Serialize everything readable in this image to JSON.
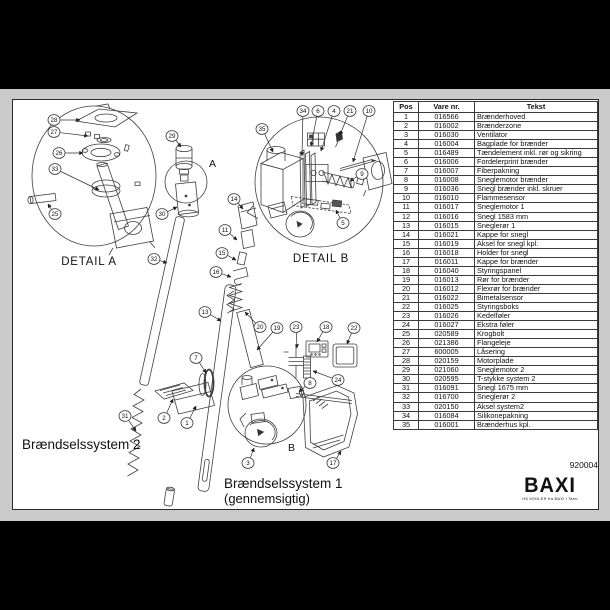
{
  "page": {
    "sheet_number": "920004"
  },
  "logo": {
    "brand": "BAXI",
    "tagline": "HS KEDLER fra BAXI i Tarm"
  },
  "labels": {
    "detail_a": "DETAIL A",
    "detail_b": "DETAIL B",
    "system2": "Brændselssystem 2",
    "system1": "Brændselssystem 1",
    "system1_sub": "(gennemsigtig)",
    "marker_a": "A",
    "marker_b": "B"
  },
  "table": {
    "headers": [
      "Pos",
      "Vare nr.",
      "Tekst"
    ],
    "rows": [
      [
        "1",
        "016566",
        "Brænderhoved"
      ],
      [
        "2",
        "016002",
        "Brænderzone"
      ],
      [
        "3",
        "016030",
        "Ventilator"
      ],
      [
        "4",
        "016004",
        "Bagplade for brænder"
      ],
      [
        "5",
        "016489",
        "Tændelement inkl. rør og sikring"
      ],
      [
        "6",
        "016006",
        "Fordelerprint brænder"
      ],
      [
        "7",
        "016007",
        "Fiberpakning"
      ],
      [
        "8",
        "016008",
        "Sneglemotor brænder"
      ],
      [
        "9",
        "016036",
        "Snegl brænder inkl. skruer"
      ],
      [
        "10",
        "016010",
        "Flammesensor"
      ],
      [
        "11",
        "016017",
        "Sneglemotor 1"
      ],
      [
        "12",
        "016016",
        "Snegl 1583 mm"
      ],
      [
        "13",
        "016015",
        "Sneglerør 1"
      ],
      [
        "14",
        "016021",
        "Kappe for snegl"
      ],
      [
        "15",
        "016019",
        "Aksel for snegl kpl."
      ],
      [
        "16",
        "016018",
        "Holder for snegl"
      ],
      [
        "17",
        "016011",
        "Kappe for brænder"
      ],
      [
        "18",
        "016040",
        "Styringspanel"
      ],
      [
        "19",
        "016013",
        "Rør for brænder"
      ],
      [
        "20",
        "016012",
        "Flexrør for brænder"
      ],
      [
        "21",
        "016022",
        "Bimetalsensor"
      ],
      [
        "22",
        "016025",
        "Styringsboks"
      ],
      [
        "23",
        "016026",
        "Kedelføler"
      ],
      [
        "24",
        "016027",
        "Ekstra føler"
      ],
      [
        "25",
        "020589",
        "Krogbolt"
      ],
      [
        "26",
        "021386",
        "Flangeleje"
      ],
      [
        "27",
        "600005",
        "Låsering"
      ],
      [
        "28",
        "020159",
        "Motorplade"
      ],
      [
        "29",
        "021060",
        "Sneglemotor 2"
      ],
      [
        "30",
        "020595",
        "T-stykke system 2"
      ],
      [
        "31",
        "016091",
        "Snegl 1675 mm"
      ],
      [
        "32",
        "016700",
        "Sneglerør 2"
      ],
      [
        "33",
        "020150",
        "Aksel system2"
      ],
      [
        "34",
        "016084",
        "Silikonepakning"
      ],
      [
        "35",
        "016001",
        "Brænderhus kpl."
      ]
    ]
  },
  "diagram": {
    "callouts": [
      {
        "n": "1",
        "x": 187,
        "y": 423,
        "tx": 196,
        "ty": 406
      },
      {
        "n": "2",
        "x": 164,
        "y": 418,
        "tx": 173,
        "ty": 399
      },
      {
        "n": "3",
        "x": 248,
        "y": 463,
        "tx": 254,
        "ty": 448
      },
      {
        "n": "4",
        "x": 334,
        "y": 111,
        "tx": 321,
        "ty": 151
      },
      {
        "n": "5",
        "x": 343,
        "y": 223,
        "tx": 336,
        "ty": 210
      },
      {
        "n": "6",
        "x": 318,
        "y": 111,
        "tx": 311,
        "ty": 146
      },
      {
        "n": "7",
        "x": 196,
        "y": 358,
        "tx": 206,
        "ty": 373
      },
      {
        "n": "8",
        "x": 310,
        "y": 383,
        "tx": 299,
        "ty": 392
      },
      {
        "n": "9",
        "x": 362,
        "y": 174,
        "tx": 350,
        "ty": 181
      },
      {
        "n": "10",
        "x": 369,
        "y": 111,
        "tx": 353,
        "ty": 162
      },
      {
        "n": "11",
        "x": 225,
        "y": 230,
        "tx": 237,
        "ty": 240
      },
      {
        "n": "13",
        "x": 205,
        "y": 312,
        "tx": 221,
        "ty": 321
      },
      {
        "n": "14",
        "x": 234,
        "y": 199,
        "tx": 243,
        "ty": 209
      },
      {
        "n": "15",
        "x": 222,
        "y": 253,
        "tx": 236,
        "ty": 260
      },
      {
        "n": "16",
        "x": 216,
        "y": 272,
        "tx": 231,
        "ty": 277
      },
      {
        "n": "17",
        "x": 333,
        "y": 463,
        "tx": 341,
        "ty": 451
      },
      {
        "n": "18",
        "x": 326,
        "y": 327,
        "tx": 317,
        "ty": 342
      },
      {
        "n": "19",
        "x": 277,
        "y": 328,
        "tx": 257,
        "ty": 350
      },
      {
        "n": "20",
        "x": 260,
        "y": 327,
        "tx": 245,
        "ty": 312
      },
      {
        "n": "21",
        "x": 350,
        "y": 111,
        "tx": 340,
        "ty": 135
      },
      {
        "n": "22",
        "x": 354,
        "y": 328,
        "tx": 347,
        "ty": 344
      },
      {
        "n": "23",
        "x": 296,
        "y": 327,
        "tx": 297,
        "ty": 348
      },
      {
        "n": "24",
        "x": 338,
        "y": 380,
        "tx": 313,
        "ty": 371
      },
      {
        "n": "25",
        "x": 55,
        "y": 214,
        "tx": 48,
        "ty": 204
      },
      {
        "n": "26",
        "x": 59,
        "y": 153,
        "tx": 83,
        "ty": 153
      },
      {
        "n": "27",
        "x": 54,
        "y": 132,
        "tx": 88,
        "ty": 136
      },
      {
        "n": "28",
        "x": 54,
        "y": 120,
        "tx": 80,
        "ty": 120
      },
      {
        "n": "29",
        "x": 172,
        "y": 136,
        "tx": 181,
        "ty": 147
      },
      {
        "n": "30",
        "x": 162,
        "y": 214,
        "tx": 177,
        "ty": 207
      },
      {
        "n": "31",
        "x": 125,
        "y": 416,
        "tx": 136,
        "ty": 431
      },
      {
        "n": "32",
        "x": 154,
        "y": 259,
        "tx": 167,
        "ty": 263
      },
      {
        "n": "33",
        "x": 55,
        "y": 169,
        "tx": 99,
        "ty": 190
      },
      {
        "n": "34",
        "x": 303,
        "y": 111,
        "tx": 302,
        "ty": 156
      },
      {
        "n": "35",
        "x": 262,
        "y": 129,
        "tx": 273,
        "ty": 152
      }
    ]
  }
}
